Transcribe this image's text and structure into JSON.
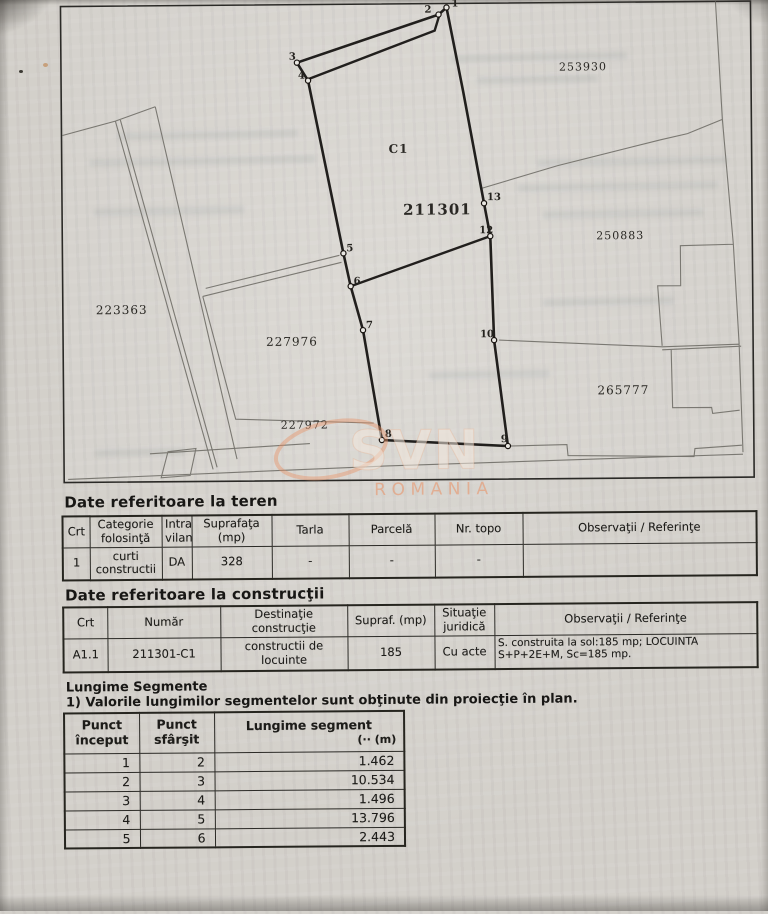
{
  "map": {
    "points": [
      "1",
      "2",
      "3",
      "4",
      "5",
      "6",
      "7",
      "8",
      "9",
      "10",
      "12",
      "13"
    ],
    "parcels": {
      "p253930": "253930",
      "c1": "C1",
      "main": "211301",
      "p250883": "250883",
      "p223363": "223363",
      "p227976": "227976",
      "p265777": "265777",
      "p227972": "227972"
    },
    "watermark": {
      "brand": "SVN",
      "country": "ROMANIA"
    }
  },
  "teren": {
    "title": "Date referitoare la teren",
    "headers": [
      "Crt",
      "Categorie folosinţă",
      "Intra vilan",
      "Suprafaţa (mp)",
      "Tarla",
      "Parcelă",
      "Nr. topo",
      "Observaţii / Referinţe"
    ],
    "row": [
      "1",
      "curti constructii",
      "DA",
      "328",
      "-",
      "-",
      "-",
      ""
    ]
  },
  "constructii": {
    "title": "Date referitoare la construcţii",
    "headers": [
      "Crt",
      "Număr",
      "Destinaţie construcţie",
      "Supraf. (mp)",
      "Situaţie juridică",
      "Observaţii / Referinţe"
    ],
    "row": [
      "A1.1",
      "211301-C1",
      "constructii de locuinte",
      "185",
      "Cu acte",
      "S. construita la sol:185 mp;  LOCUINTA S+P+2E+M, Sc=185 mp."
    ]
  },
  "segmente": {
    "title": "Lungime Segmente",
    "note": "1) Valorile lungimilor segmentelor sunt obţinute din proiecţie în plan.",
    "headers": [
      "Punct început",
      "Punct sfârşit",
      "Lungime segment",
      "(·· (m)"
    ],
    "rows": [
      [
        "1",
        "2",
        "1.462"
      ],
      [
        "2",
        "3",
        "10.534"
      ],
      [
        "3",
        "4",
        "1.496"
      ],
      [
        "4",
        "5",
        "13.796"
      ],
      [
        "5",
        "6",
        "2.443"
      ]
    ]
  }
}
